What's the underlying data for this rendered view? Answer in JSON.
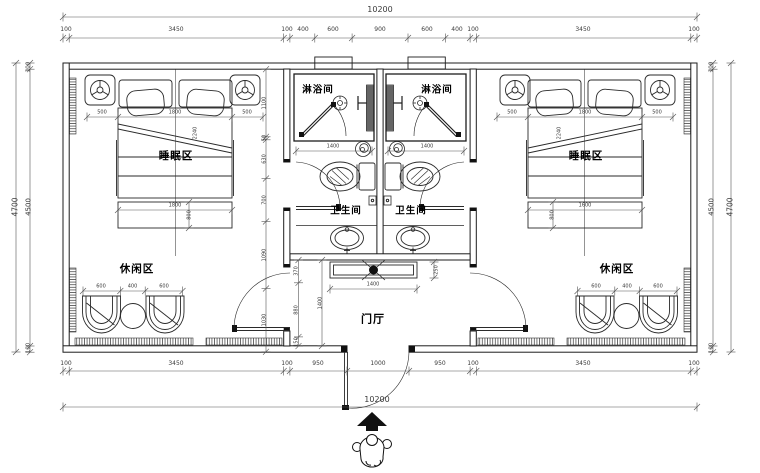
{
  "drawing": {
    "title_hint": "hotel twin-unit floor plan",
    "rooms": {
      "sleep": "睡眠区",
      "leisure": "休闲区",
      "shower": "淋浴间",
      "wc": "卫生间",
      "hall": "门厅"
    },
    "dims": {
      "overall_w": "10200",
      "overall_h": "4700",
      "inner_h": "4500",
      "wall": "100",
      "top_chain": [
        "100",
        "3450",
        "100",
        "400",
        "600",
        "900",
        "600",
        "400",
        "100",
        "3450",
        "100"
      ],
      "bottom_chain": [
        "100",
        "3450",
        "100",
        "950",
        "1000",
        "950",
        "100",
        "3450",
        "100"
      ],
      "bed_row": [
        "500",
        "1800",
        "500"
      ],
      "left_inner_chain": [
        "1100",
        "50",
        "630",
        "700",
        "1090",
        "1030"
      ],
      "leisure_row": [
        "600",
        "400",
        "600"
      ],
      "wc_width": "1400",
      "console_width": "1400",
      "console_depth": "250",
      "hall_chain": [
        "370",
        "880",
        "150"
      ],
      "hall_height": "1400",
      "bed_foot_left_w": "1800",
      "bed_foot_left_h": "800",
      "bed_foot_right_w": "1600",
      "bed_foot_right_h": "800",
      "bed_diag": "2240"
    },
    "colors": {
      "line": "#2a2a2a",
      "dim": "#555555",
      "fill": "#ffffff"
    }
  }
}
